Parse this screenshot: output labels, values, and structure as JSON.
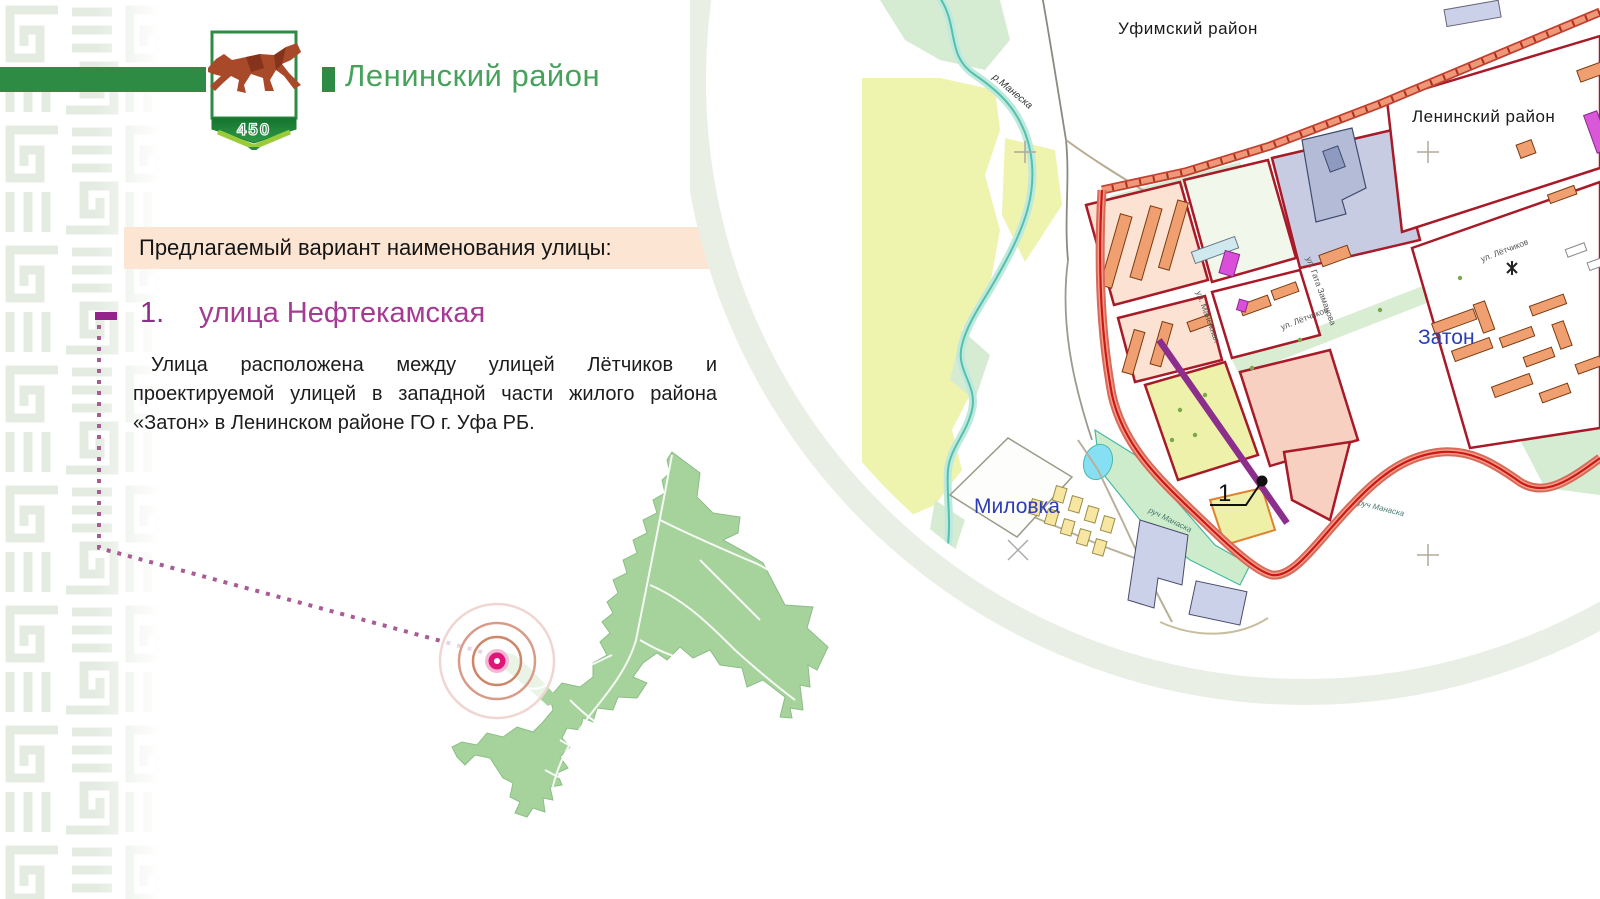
{
  "header": {
    "district_title": "Ленинский район",
    "logo_year": "450"
  },
  "proposal": {
    "label": "Предлагаемый вариант наименования улицы:",
    "item_number": "1.",
    "street_name": "улица Нефтекамская",
    "description": "Улица расположена между улицей Лётчиков и проектируемой улицей в западной части жилого района «Затон» в Ленинском районе ГО г. Уфа РБ."
  },
  "map": {
    "labels": {
      "ufimsky_district": "Уфимский район",
      "leninsky_district": "Ленинский район",
      "zaton": "Затон",
      "milovka": "Миловка",
      "river_maneska": "р.Манеска",
      "stream_manaska_1": "руч Манаска",
      "stream_manaska_2": "руч Манаска",
      "street_letchikov_1": "ул. Лётчиков",
      "street_letchikov_2": "ул. Лётчиков",
      "street_manezhnaya": "ул. Манежная",
      "street_gata_zamanova": "ул. Гата Заманова",
      "marker_number": "1"
    }
  },
  "colors": {
    "accent_green": "#2e8b43",
    "title_green": "#46a25b",
    "highlight_bg": "#fce5d2",
    "heading_magenta": "#a43a92",
    "marker_pink": "#dd1677",
    "map_label_blue": "#2b3db6",
    "boundary_red": "#cc1818",
    "proposed_street_purple": "#8c2f8c",
    "silhouette_green": "#a6d29c"
  }
}
